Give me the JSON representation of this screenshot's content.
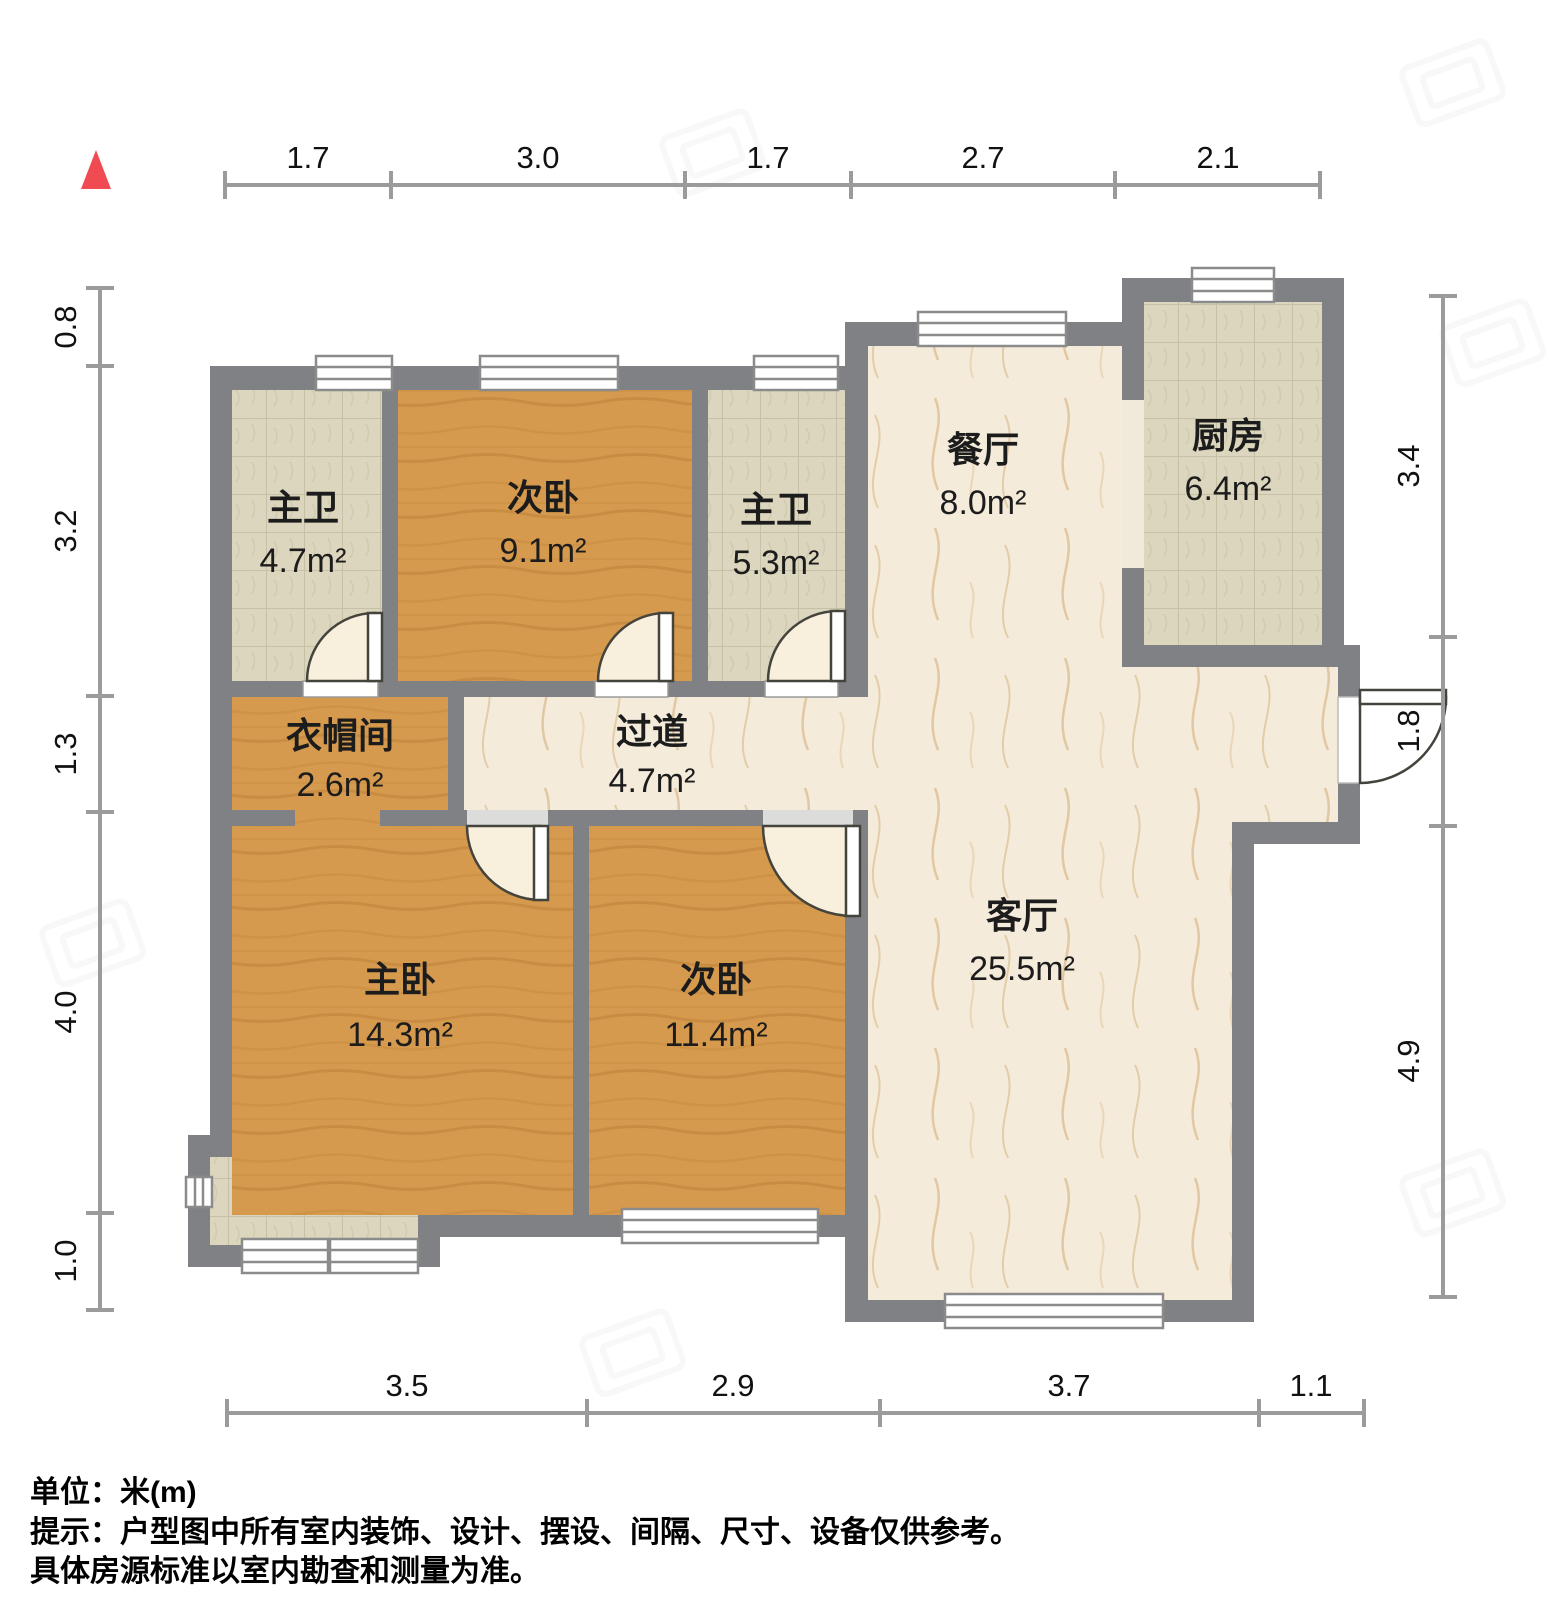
{
  "plan": {
    "type": "apartment-floorplan",
    "colors": {
      "wall": "#808184",
      "wood_floor": "#d69a4e",
      "tile_floor": "#dbd6bd",
      "marble_floor": "#f4ebda",
      "dimension_line": "#9b9b9b",
      "north_arrow": "#f04b52"
    }
  },
  "rooms": [
    {
      "name": "主卫",
      "area": "4.7m²"
    },
    {
      "name": "次卧",
      "area": "9.1m²"
    },
    {
      "name": "主卫",
      "area": "5.3m²"
    },
    {
      "name": "餐厅",
      "area": "8.0m²"
    },
    {
      "name": "厨房",
      "area": "6.4m²"
    },
    {
      "name": "衣帽间",
      "area": "2.6m²"
    },
    {
      "name": "过道",
      "area": "4.7m²"
    },
    {
      "name": "主卧",
      "area": "14.3m²"
    },
    {
      "name": "次卧",
      "area": "11.4m²"
    },
    {
      "name": "客厅",
      "area": "25.5m²"
    }
  ],
  "dimensions": {
    "top": [
      "1.7",
      "3.0",
      "1.7",
      "2.7",
      "2.1"
    ],
    "left": [
      "0.8",
      "3.2",
      "1.3",
      "4.0",
      "1.0"
    ],
    "right": [
      "3.4",
      "1.8",
      "4.9"
    ],
    "bottom": [
      "3.5",
      "2.9",
      "3.7",
      "1.1"
    ]
  },
  "notes": {
    "unit": "单位：米(m)",
    "tip_line1": "提示：户型图中所有室内装饰、设计、摆设、间隔、尺寸、设备仅供参考。",
    "tip_line2": "具体房源标准以室内勘查和测量为准。"
  }
}
